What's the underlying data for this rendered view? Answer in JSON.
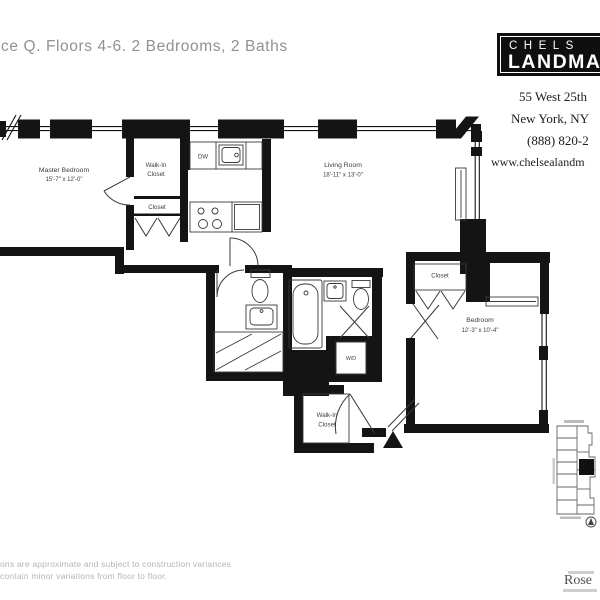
{
  "page": {
    "title_fragment": "ce Q. Floors 4-6. 2 Bedrooms, 2 Baths"
  },
  "logo": {
    "line1": "CHELS",
    "line2": "LANDMA"
  },
  "contact": {
    "address_line1": "55 West 25th",
    "address_line2": "New York, NY",
    "phone_fragment": "(888) 820-2",
    "website_fragment": "www.chelsealandm"
  },
  "floorplan": {
    "rooms": {
      "master_bedroom": {
        "name": "Master Bedroom",
        "dims": "15'-7\" x 12'-0\""
      },
      "living_room": {
        "name": "Living Room",
        "dims": "18'-11\" x 13'-0\""
      },
      "bedroom": {
        "name": "Bedroom",
        "dims": "12'-3\" x 10'-4\""
      }
    },
    "labels": {
      "walk_in": "Walk-In",
      "closet": "Closet",
      "dishwasher": "DW",
      "washer_dryer": "W/D"
    }
  },
  "footer": {
    "disclaimer_line1": "ons are approximate and subject to construction variances",
    "disclaimer_line2": "contain minor variations from floor to floor.",
    "brand_fragment": "Rose"
  }
}
